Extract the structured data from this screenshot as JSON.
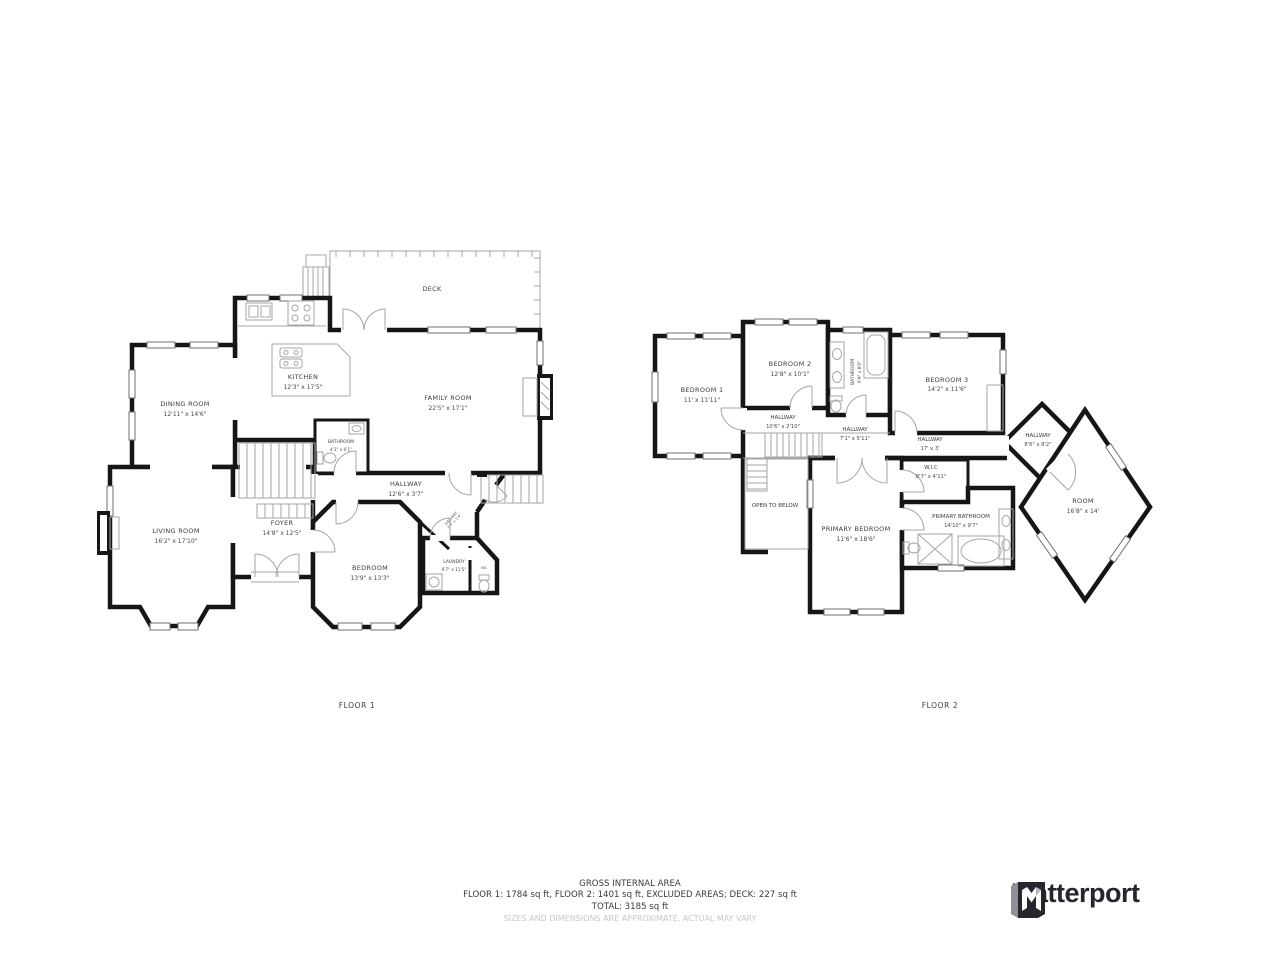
{
  "floor1": {
    "caption": "FLOOR 1",
    "deck": {
      "name": "DECK"
    },
    "kitchen": {
      "name": "KITCHEN",
      "dims": "12'3\" x 17'5\""
    },
    "dining_room": {
      "name": "DINING ROOM",
      "dims": "12'11\" x 14'6\""
    },
    "family_room": {
      "name": "FAMILY ROOM",
      "dims": "22'5\" x 17'1\""
    },
    "bathroom": {
      "name": "BATHROOM",
      "dims": "4'3\" x 6'1\""
    },
    "hallway": {
      "name": "HALLWAY",
      "dims": "12'6\" x 3'7\""
    },
    "hallway_small": {
      "name": "HALLWAY",
      "dims": "3'7\" x 1'4\""
    },
    "living_room": {
      "name": "LIVING ROOM",
      "dims": "16'2\" x 17'10\""
    },
    "foyer": {
      "name": "FOYER",
      "dims": "14'8\" x 12'5\""
    },
    "bedroom": {
      "name": "BEDROOM",
      "dims": "13'9\" x 13'3\""
    },
    "laundry": {
      "name": "LAUNDRY",
      "dims": "6'7\" x 11'5\""
    },
    "wc": {
      "name": "WC"
    }
  },
  "floor2": {
    "caption": "FLOOR 2",
    "bedroom1": {
      "name": "BEDROOM 1",
      "dims": "11' x 11'11\""
    },
    "bedroom2": {
      "name": "BEDROOM 2",
      "dims": "12'8\" x 10'1\""
    },
    "bathroom": {
      "name": "BATHROOM",
      "dims": "6'9\" x 8'6\""
    },
    "bedroom3": {
      "name": "BEDROOM 3",
      "dims": "14'2\" x 11'6\""
    },
    "hallway_a": {
      "name": "HALLWAY",
      "dims": "10'6\" x 2'10\""
    },
    "hallway_b": {
      "name": "HALLWAY",
      "dims": "7'1\" x 5'11\""
    },
    "hallway_c": {
      "name": "HALLWAY",
      "dims": "17' x 3'"
    },
    "hallway_d": {
      "name": "HALLWAY",
      "dims": "8'6\" x 8'2\""
    },
    "wic": {
      "name": "W.I.C",
      "dims": "8'7\" x 4'11\""
    },
    "open_to_below": {
      "name": "OPEN TO BELOW"
    },
    "primary_bedroom": {
      "name": "PRIMARY BEDROOM",
      "dims": "11'6\" x 18'6\""
    },
    "primary_bathroom": {
      "name": "PRIMARY BATHROOM",
      "dims": "14'10\" x 9'7\""
    },
    "room": {
      "name": "ROOM",
      "dims": "16'8\" x 14'"
    }
  },
  "footer": {
    "title": "GROSS INTERNAL AREA",
    "line1": "FLOOR 1: 1784 sq ft, FLOOR 2: 1401 sq ft, EXCLUDED AREAS; DECK: 227 sq ft",
    "line2": "TOTAL: 3185 sq ft",
    "disclaimer": "SIZES AND DIMENSIONS ARE APPROXIMATE, ACTUAL MAY VARY"
  },
  "branding": {
    "logo_text": "Matterport"
  },
  "colors": {
    "wall": "#161616",
    "detail": "#a6a6a6",
    "label": "#3c3c3c",
    "disclaimer": "#c8c8c8",
    "brand": "#26262c"
  }
}
